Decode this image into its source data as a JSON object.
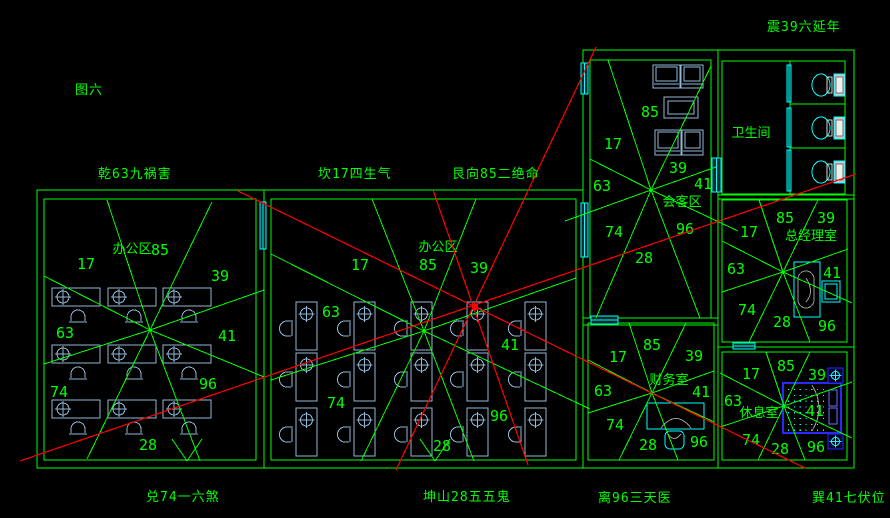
{
  "title": {
    "text": "图六"
  },
  "colors": {
    "background": "#000000",
    "wall_green": "#00ff00",
    "analysis_red": "#ff0000",
    "fixture_cyan": "#00ffff",
    "furniture_blue_grey": "#8fb8d8",
    "bed_blue": "#2828ff",
    "chair_grey": "#9a9a9a"
  },
  "compass_labels": [
    {
      "id": "figure-title",
      "text": "图六",
      "x": 75,
      "y": 79
    },
    {
      "id": "label-qian",
      "text": "乾63九祸害",
      "x": 98,
      "y": 163
    },
    {
      "id": "label-kan",
      "text": "坎17四生气",
      "x": 318,
      "y": 163
    },
    {
      "id": "label-gen",
      "text": "艮向85二绝命",
      "x": 452,
      "y": 163
    },
    {
      "id": "label-zhen",
      "text": "震39六延年",
      "x": 767,
      "y": 16
    },
    {
      "id": "label-dui",
      "text": "兑74一六煞",
      "x": 146,
      "y": 486
    },
    {
      "id": "label-kun",
      "text": "坤山28五五鬼",
      "x": 423,
      "y": 486
    },
    {
      "id": "label-li",
      "text": "离96三天医",
      "x": 598,
      "y": 487
    },
    {
      "id": "label-xun",
      "text": "巽41七伏位",
      "x": 812,
      "y": 487
    }
  ],
  "rooms": [
    {
      "id": "office-left",
      "label": {
        "text": "办公区",
        "x": 132,
        "y": 248
      },
      "outer": [
        37,
        190,
        227,
        278
      ],
      "inner": [
        44,
        199,
        212,
        261
      ],
      "star": {
        "cx": 150,
        "cy": 330,
        "rays": [
          [
            44,
            276
          ],
          [
            107,
            200
          ],
          [
            212,
            202
          ],
          [
            264,
            290
          ],
          [
            264,
            377
          ],
          [
            200,
            461
          ],
          [
            87,
            459
          ],
          [
            44,
            364
          ]
        ]
      },
      "numbers": [
        {
          "t": "17",
          "x": 86,
          "y": 264
        },
        {
          "t": "85",
          "x": 160,
          "y": 250
        },
        {
          "t": "39",
          "x": 220,
          "y": 276
        },
        {
          "t": "63",
          "x": 65,
          "y": 333
        },
        {
          "t": "41",
          "x": 227,
          "y": 336
        },
        {
          "t": "74",
          "x": 59,
          "y": 392
        },
        {
          "t": "96",
          "x": 208,
          "y": 384
        },
        {
          "t": "28",
          "x": 148,
          "y": 445
        }
      ]
    },
    {
      "id": "office-middle",
      "label": {
        "text": "办公区",
        "x": 438,
        "y": 246
      },
      "outer": [
        264,
        190,
        319,
        278
      ],
      "inner": [
        271,
        199,
        305,
        261
      ],
      "star": {
        "cx": 424,
        "cy": 331,
        "rays": [
          [
            271,
            254
          ],
          [
            372,
            199
          ],
          [
            476,
            199
          ],
          [
            576,
            278
          ],
          [
            590,
            409
          ],
          [
            474,
            461
          ],
          [
            361,
            461
          ],
          [
            271,
            380
          ]
        ]
      },
      "numbers": [
        {
          "t": "17",
          "x": 360,
          "y": 265
        },
        {
          "t": "85",
          "x": 428,
          "y": 265
        },
        {
          "t": "39",
          "x": 479,
          "y": 268
        },
        {
          "t": "63",
          "x": 331,
          "y": 312
        },
        {
          "t": "41",
          "x": 510,
          "y": 345
        },
        {
          "t": "74",
          "x": 336,
          "y": 403
        },
        {
          "t": "96",
          "x": 499,
          "y": 416
        },
        {
          "t": "28",
          "x": 442,
          "y": 446
        }
      ]
    },
    {
      "id": "meeting-area",
      "label": {
        "text": "会客区",
        "x": 682,
        "y": 201
      },
      "outer": [
        583,
        50,
        135,
        275
      ],
      "inner": [
        590,
        60,
        121,
        258
      ],
      "star": {
        "cx": 651,
        "cy": 190,
        "rays": [
          [
            590,
            159
          ],
          [
            608,
            60
          ],
          [
            711,
            66
          ],
          [
            716,
            167
          ],
          [
            738,
            231
          ],
          [
            700,
            318
          ],
          [
            596,
            318
          ],
          [
            565,
            221
          ]
        ]
      },
      "numbers": [
        {
          "t": "85",
          "x": 650,
          "y": 112
        },
        {
          "t": "17",
          "x": 613,
          "y": 144
        },
        {
          "t": "39",
          "x": 678,
          "y": 168
        },
        {
          "t": "63",
          "x": 602,
          "y": 186
        },
        {
          "t": "41",
          "x": 703,
          "y": 184
        },
        {
          "t": "74",
          "x": 614,
          "y": 232
        },
        {
          "t": "96",
          "x": 685,
          "y": 229
        },
        {
          "t": "28",
          "x": 644,
          "y": 258
        }
      ]
    },
    {
      "id": "bathroom",
      "label": {
        "text": "卫生间",
        "x": 751,
        "y": 132
      },
      "outer": [
        718,
        50,
        136,
        149
      ],
      "inner": [
        722,
        61,
        123,
        133
      ],
      "star": null,
      "numbers": []
    },
    {
      "id": "gm-office",
      "label": {
        "text": "总经理室",
        "x": 811,
        "y": 235
      },
      "outer": [
        718,
        195,
        136,
        152
      ],
      "inner": [
        722,
        200,
        125,
        142
      ],
      "star": {
        "cx": 783,
        "cy": 272,
        "rays": [
          [
            722,
            241
          ],
          [
            759,
            200
          ],
          [
            818,
            200
          ],
          [
            848,
            249
          ],
          [
            852,
            303
          ],
          [
            810,
            342
          ],
          [
            749,
            342
          ],
          [
            722,
            292
          ]
        ]
      },
      "numbers": [
        {
          "t": "85",
          "x": 785,
          "y": 218
        },
        {
          "t": "39",
          "x": 826,
          "y": 218
        },
        {
          "t": "17",
          "x": 749,
          "y": 232
        },
        {
          "t": "63",
          "x": 736,
          "y": 269
        },
        {
          "t": "41",
          "x": 832,
          "y": 273
        },
        {
          "t": "74",
          "x": 747,
          "y": 310
        },
        {
          "t": "28",
          "x": 782,
          "y": 322
        },
        {
          "t": "96",
          "x": 827,
          "y": 326
        }
      ]
    },
    {
      "id": "finance-office",
      "label": {
        "text": "财务室",
        "x": 669,
        "y": 379
      },
      "outer": [
        583,
        318,
        135,
        150
      ],
      "inner": [
        588,
        323,
        126,
        137
      ],
      "star": {
        "cx": 652,
        "cy": 393,
        "rays": [
          [
            588,
            360
          ],
          [
            629,
            323
          ],
          [
            686,
            323
          ],
          [
            714,
            371
          ],
          [
            714,
            422
          ],
          [
            678,
            460
          ],
          [
            619,
            460
          ],
          [
            588,
            413
          ]
        ]
      },
      "numbers": [
        {
          "t": "85",
          "x": 652,
          "y": 345
        },
        {
          "t": "17",
          "x": 618,
          "y": 357
        },
        {
          "t": "39",
          "x": 694,
          "y": 356
        },
        {
          "t": "63",
          "x": 603,
          "y": 391
        },
        {
          "t": "41",
          "x": 701,
          "y": 392
        },
        {
          "t": "74",
          "x": 615,
          "y": 425
        },
        {
          "t": "28",
          "x": 648,
          "y": 445
        },
        {
          "t": "96",
          "x": 699,
          "y": 442
        }
      ]
    },
    {
      "id": "rest-room",
      "label": {
        "text": "休息室",
        "x": 759,
        "y": 412
      },
      "outer": [
        718,
        347,
        136,
        121
      ],
      "inner": [
        722,
        352,
        125,
        108
      ],
      "star": {
        "cx": 784,
        "cy": 406,
        "rays": [
          [
            720,
            373
          ],
          [
            766,
            352
          ],
          [
            810,
            352
          ],
          [
            852,
            382
          ],
          [
            852,
            438
          ],
          [
            805,
            460
          ],
          [
            758,
            460
          ],
          [
            720,
            427
          ]
        ]
      },
      "numbers": [
        {
          "t": "85",
          "x": 786,
          "y": 366
        },
        {
          "t": "17",
          "x": 751,
          "y": 374
        },
        {
          "t": "39",
          "x": 817,
          "y": 375
        },
        {
          "t": "63",
          "x": 733,
          "y": 401
        },
        {
          "t": "41",
          "x": 815,
          "y": 411
        },
        {
          "t": "74",
          "x": 751,
          "y": 440
        },
        {
          "t": "28",
          "x": 780,
          "y": 449
        },
        {
          "t": "96",
          "x": 816,
          "y": 447
        }
      ]
    }
  ],
  "walls_extra": [
    [
      790,
      61,
      790,
      194
    ],
    [
      790,
      104,
      845,
      104
    ],
    [
      790,
      148,
      845,
      148
    ]
  ],
  "door_marks": [
    [
      172,
      439,
      187,
      461
    ],
    [
      202,
      439,
      187,
      461
    ],
    [
      420,
      439,
      435,
      461
    ],
    [
      450,
      439,
      435,
      461
    ]
  ],
  "windows": [
    [
      581,
      63,
      7,
      31
    ],
    [
      581,
      203,
      7,
      54
    ],
    [
      591,
      316,
      27,
      8
    ],
    [
      712,
      158,
      9,
      34
    ],
    [
      260,
      202,
      6,
      47
    ],
    [
      733,
      343,
      22,
      6
    ],
    [
      787,
      65,
      4,
      37
    ],
    [
      787,
      108,
      4,
      39
    ],
    [
      787,
      150,
      4,
      41
    ]
  ],
  "furniture": {
    "desks_h": [
      {
        "x": 52,
        "y": 288
      },
      {
        "x": 108,
        "y": 288
      },
      {
        "x": 163,
        "y": 288
      },
      {
        "x": 52,
        "y": 345
      },
      {
        "x": 108,
        "y": 345
      },
      {
        "x": 163,
        "y": 345
      },
      {
        "x": 52,
        "y": 400
      },
      {
        "x": 108,
        "y": 400
      },
      {
        "x": 163,
        "y": 400
      }
    ],
    "desks_v": [
      {
        "x": 296,
        "y": 302
      },
      {
        "x": 354,
        "y": 302
      },
      {
        "x": 411,
        "y": 302
      },
      {
        "x": 467,
        "y": 302
      },
      {
        "x": 525,
        "y": 302
      },
      {
        "x": 296,
        "y": 353
      },
      {
        "x": 354,
        "y": 353
      },
      {
        "x": 411,
        "y": 353
      },
      {
        "x": 467,
        "y": 353
      },
      {
        "x": 525,
        "y": 353
      },
      {
        "x": 296,
        "y": 408
      },
      {
        "x": 354,
        "y": 408
      },
      {
        "x": 411,
        "y": 408
      },
      {
        "x": 467,
        "y": 408
      },
      {
        "x": 525,
        "y": 408
      }
    ],
    "sofas": [
      {
        "x": 653,
        "y": 65,
        "w": 27,
        "h": 23
      },
      {
        "x": 681,
        "y": 65,
        "w": 22,
        "h": 23
      },
      {
        "x": 655,
        "y": 130,
        "w": 26,
        "h": 25
      },
      {
        "x": 682,
        "y": 130,
        "w": 21,
        "h": 25
      }
    ],
    "tables": [
      {
        "x": 664,
        "y": 97,
        "w": 34,
        "h": 21
      }
    ],
    "toilets": [
      {
        "cx": 824,
        "cy": 85
      },
      {
        "cx": 824,
        "cy": 128
      },
      {
        "cx": 824,
        "cy": 172
      }
    ],
    "gm_desk": {
      "x": 794,
      "y": 262,
      "w": 26,
      "h": 55
    },
    "cabinet": {
      "x": 822,
      "y": 281,
      "w": 18,
      "h": 21
    },
    "fin_desk": {
      "x": 647,
      "y": 403,
      "w": 57,
      "h": 26
    },
    "fin_chair": {
      "x": 665,
      "y": 431,
      "w": 19,
      "h": 18
    },
    "bed": {
      "x": 783,
      "y": 383,
      "w": 58,
      "h": 50
    },
    "nightstands": [
      {
        "x": 828,
        "y": 368
      },
      {
        "x": 828,
        "y": 434
      }
    ]
  },
  "red_lines": [
    [
      596,
      47,
      396,
      470
    ],
    [
      433,
      190,
      528,
      465
    ],
    [
      20,
      461,
      856,
      174
    ],
    [
      238,
      191,
      805,
      468
    ]
  ],
  "red_center": {
    "x": 475,
    "y": 307
  }
}
